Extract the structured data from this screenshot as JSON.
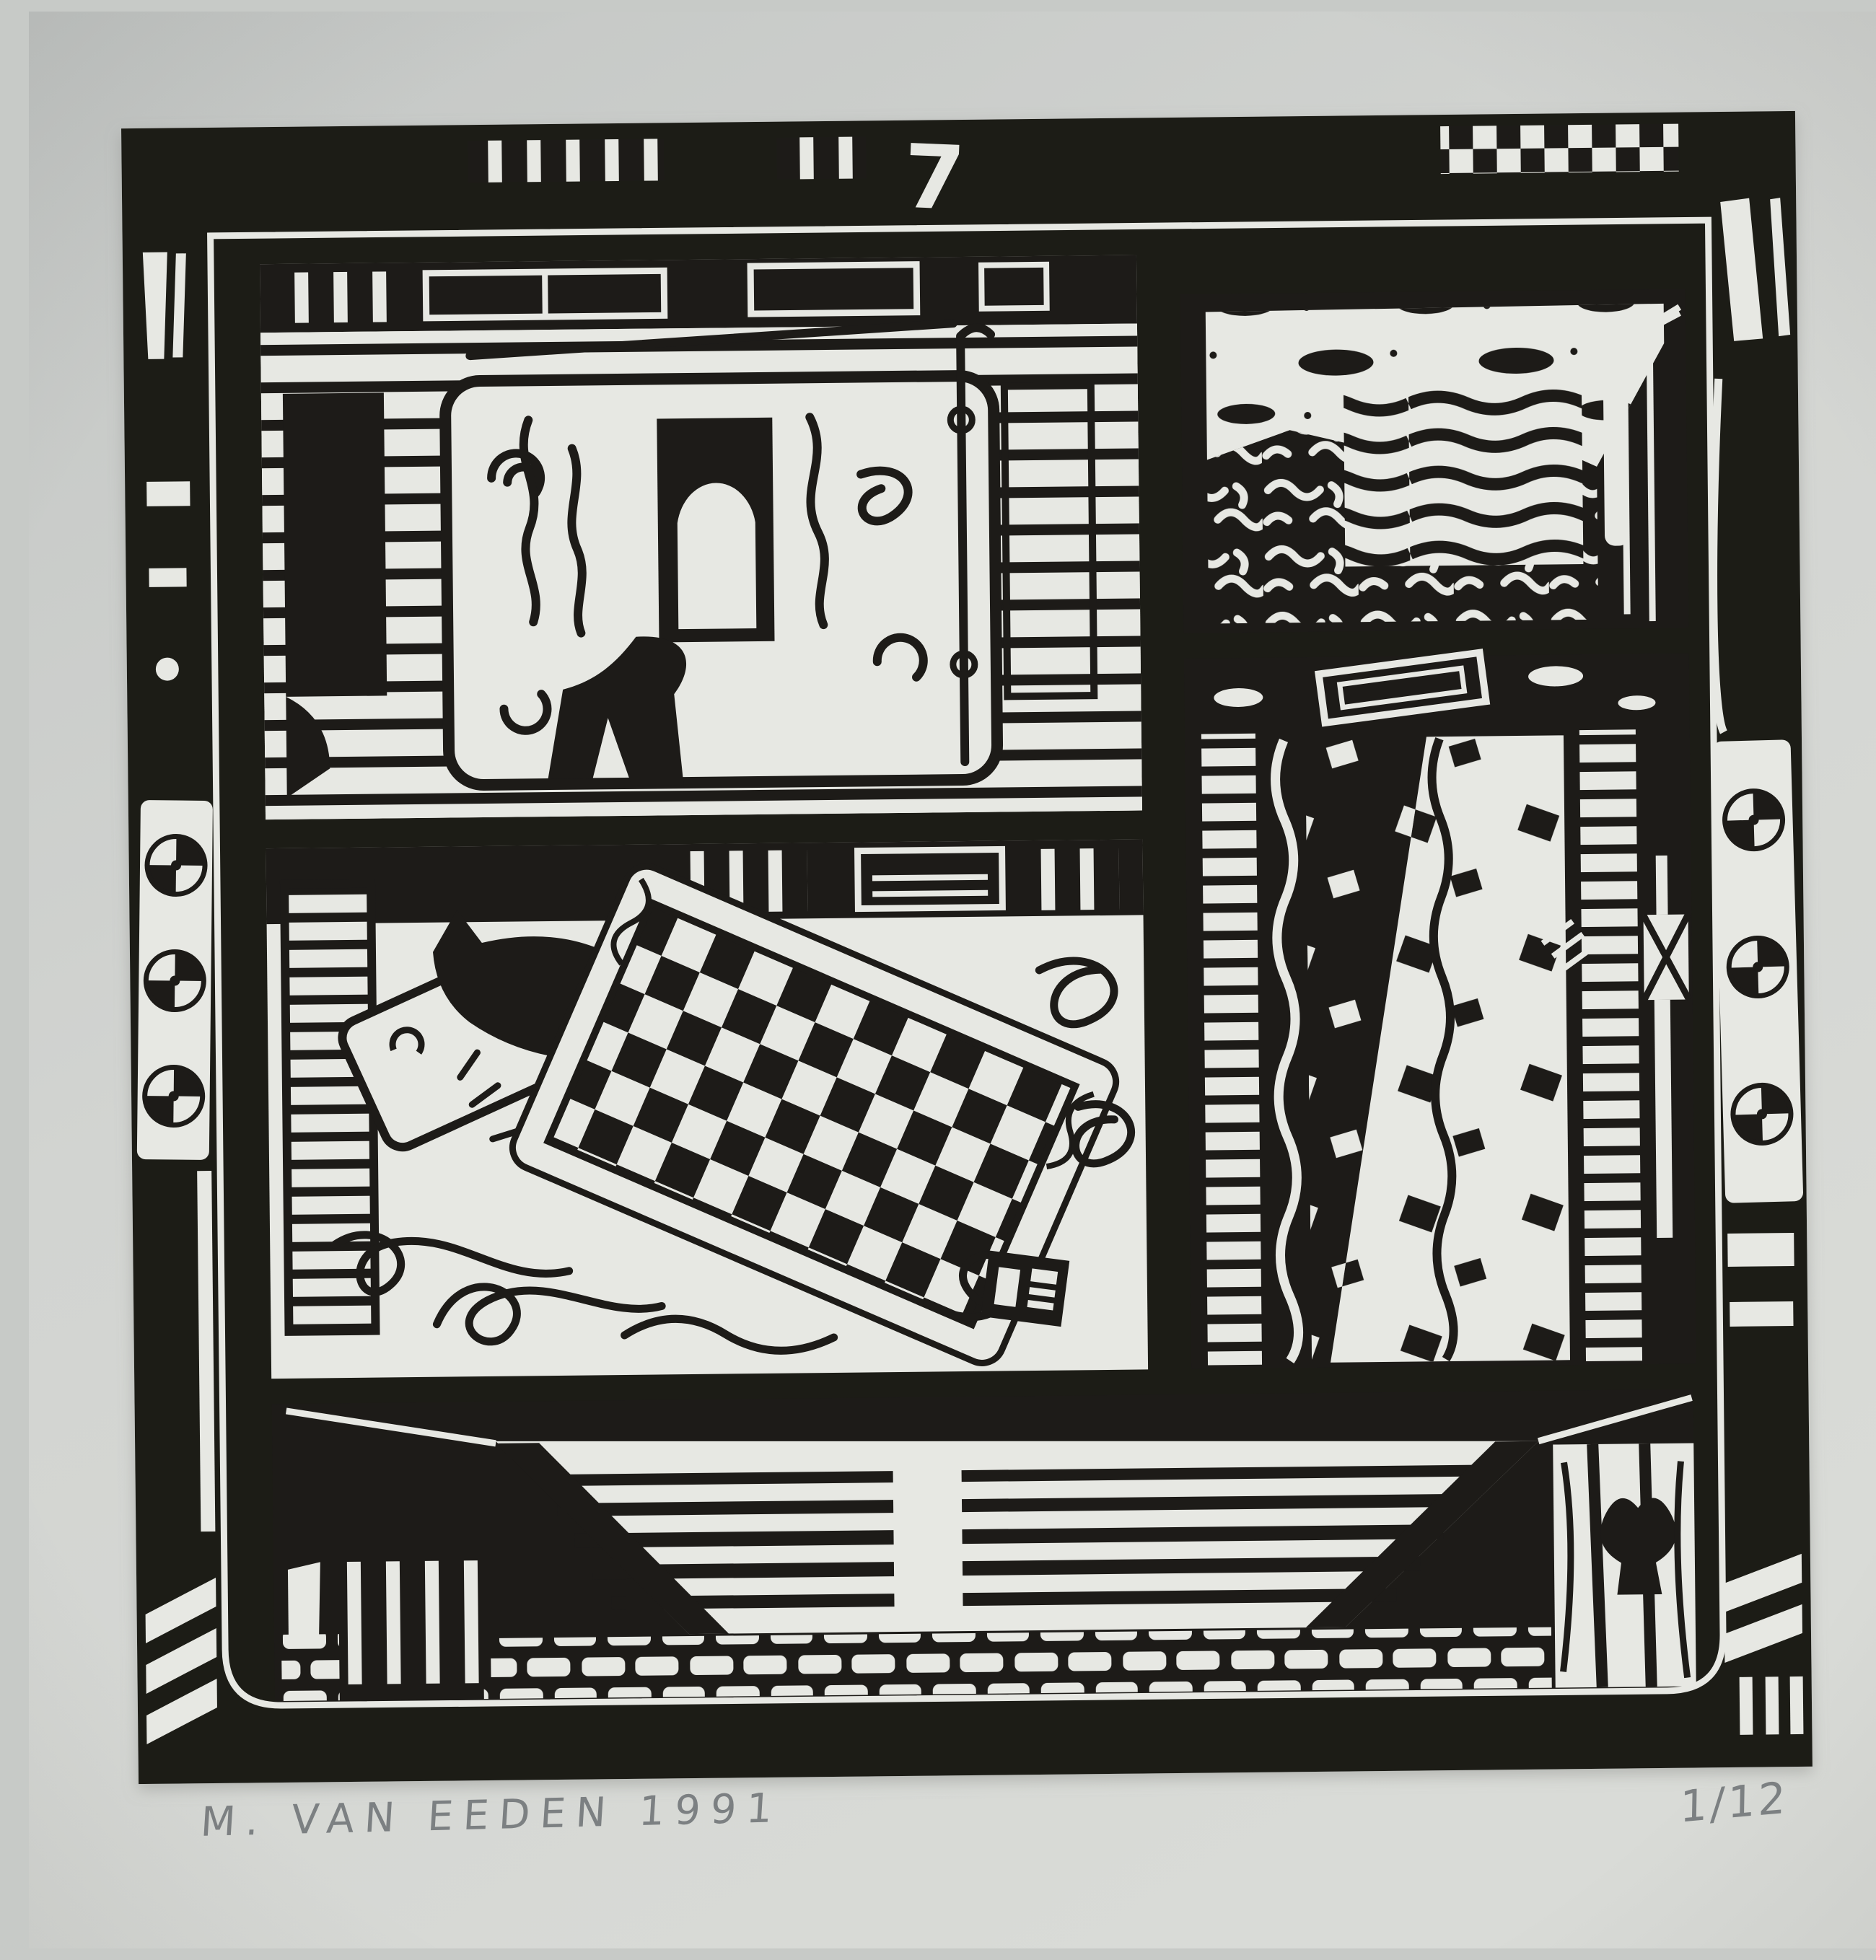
{
  "artwork": {
    "plate_number": "7",
    "signature": "M. VAN EEDEN 1991",
    "edition_fraction": "1/12"
  },
  "colors": {
    "paper": "#d2d4d1",
    "ink": "#1d1b18",
    "cut_paper_white": "#e7e8e3",
    "pencil_gray": "#6d7174"
  }
}
